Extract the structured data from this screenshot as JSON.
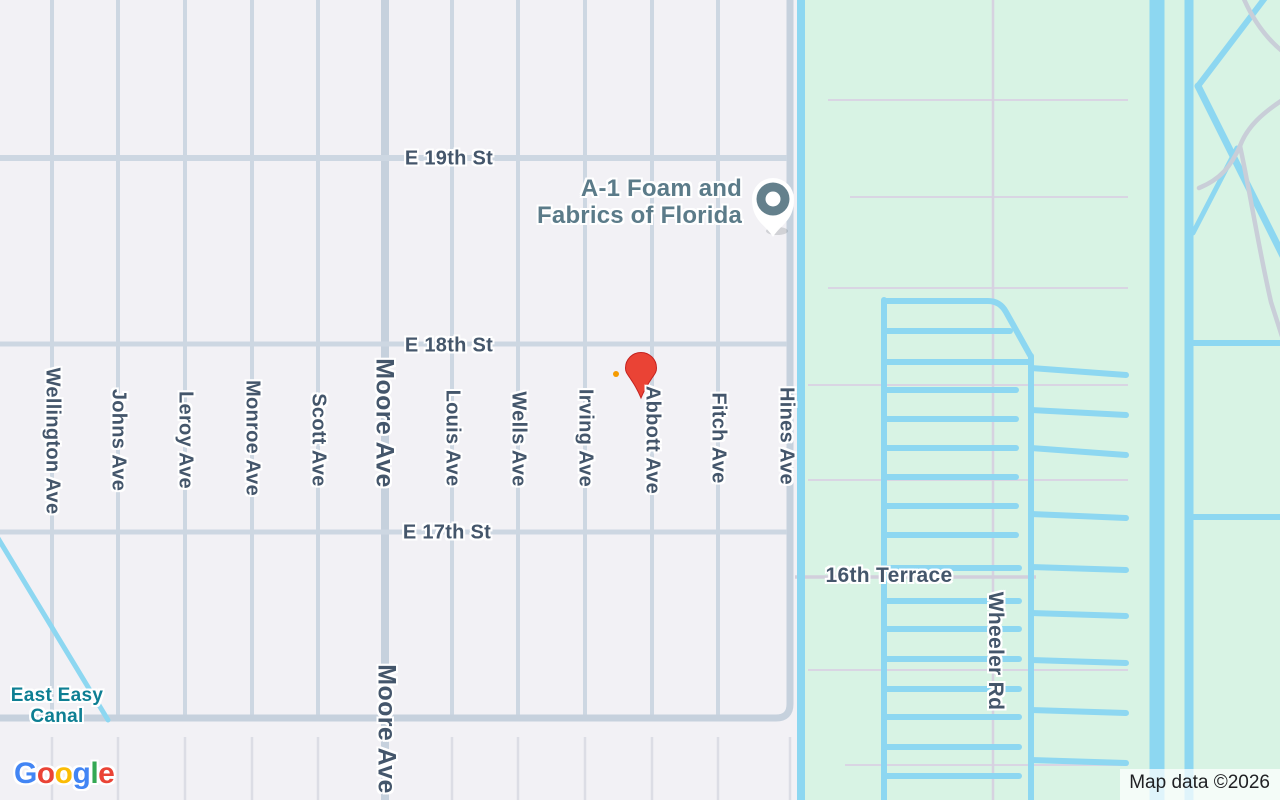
{
  "streets": {
    "horizontal": [
      "E 19th St",
      "E 18th St",
      "E 17th St"
    ],
    "avenues": [
      "Wellington Ave",
      "Johns Ave",
      "Leroy Ave",
      "Monroe Ave",
      "Scott Ave",
      "Louis Ave",
      "Wells Ave",
      "Irving Ave",
      "Abbott Ave",
      "Fitch Ave",
      "Hines Ave"
    ],
    "moore_ave": "Moore Ave",
    "wheeler_rd": "Wheeler Rd",
    "terrace": "16th Terrace"
  },
  "water": {
    "canal_label_line1": "East Easy",
    "canal_label_line2": "Canal"
  },
  "poi": {
    "label_line1": "A-1 Foam and",
    "label_line2": "Fabrics of Florida"
  },
  "logo": {
    "letters": [
      {
        "ch": "G",
        "color": "#4285F4"
      },
      {
        "ch": "o",
        "color": "#EA4335"
      },
      {
        "ch": "o",
        "color": "#FBBC05"
      },
      {
        "ch": "g",
        "color": "#4285F4"
      },
      {
        "ch": "l",
        "color": "#34A853"
      },
      {
        "ch": "e",
        "color": "#EA4335"
      }
    ]
  },
  "attribution": {
    "text": "Map data ©2026"
  },
  "palette": {
    "urban_background": "#f2f1f5",
    "green_background": "#d8f3e4",
    "road": "#cdd7e2",
    "road_major": "#c6d1dd",
    "canal": "#8dd7f1",
    "street_label": "#44566b",
    "water_label": "#0e7f93",
    "poi_label": "#5b7b89",
    "destination_pin": "#EA4335",
    "poi_pin": "#64808C",
    "attribution_text": "#202124"
  }
}
